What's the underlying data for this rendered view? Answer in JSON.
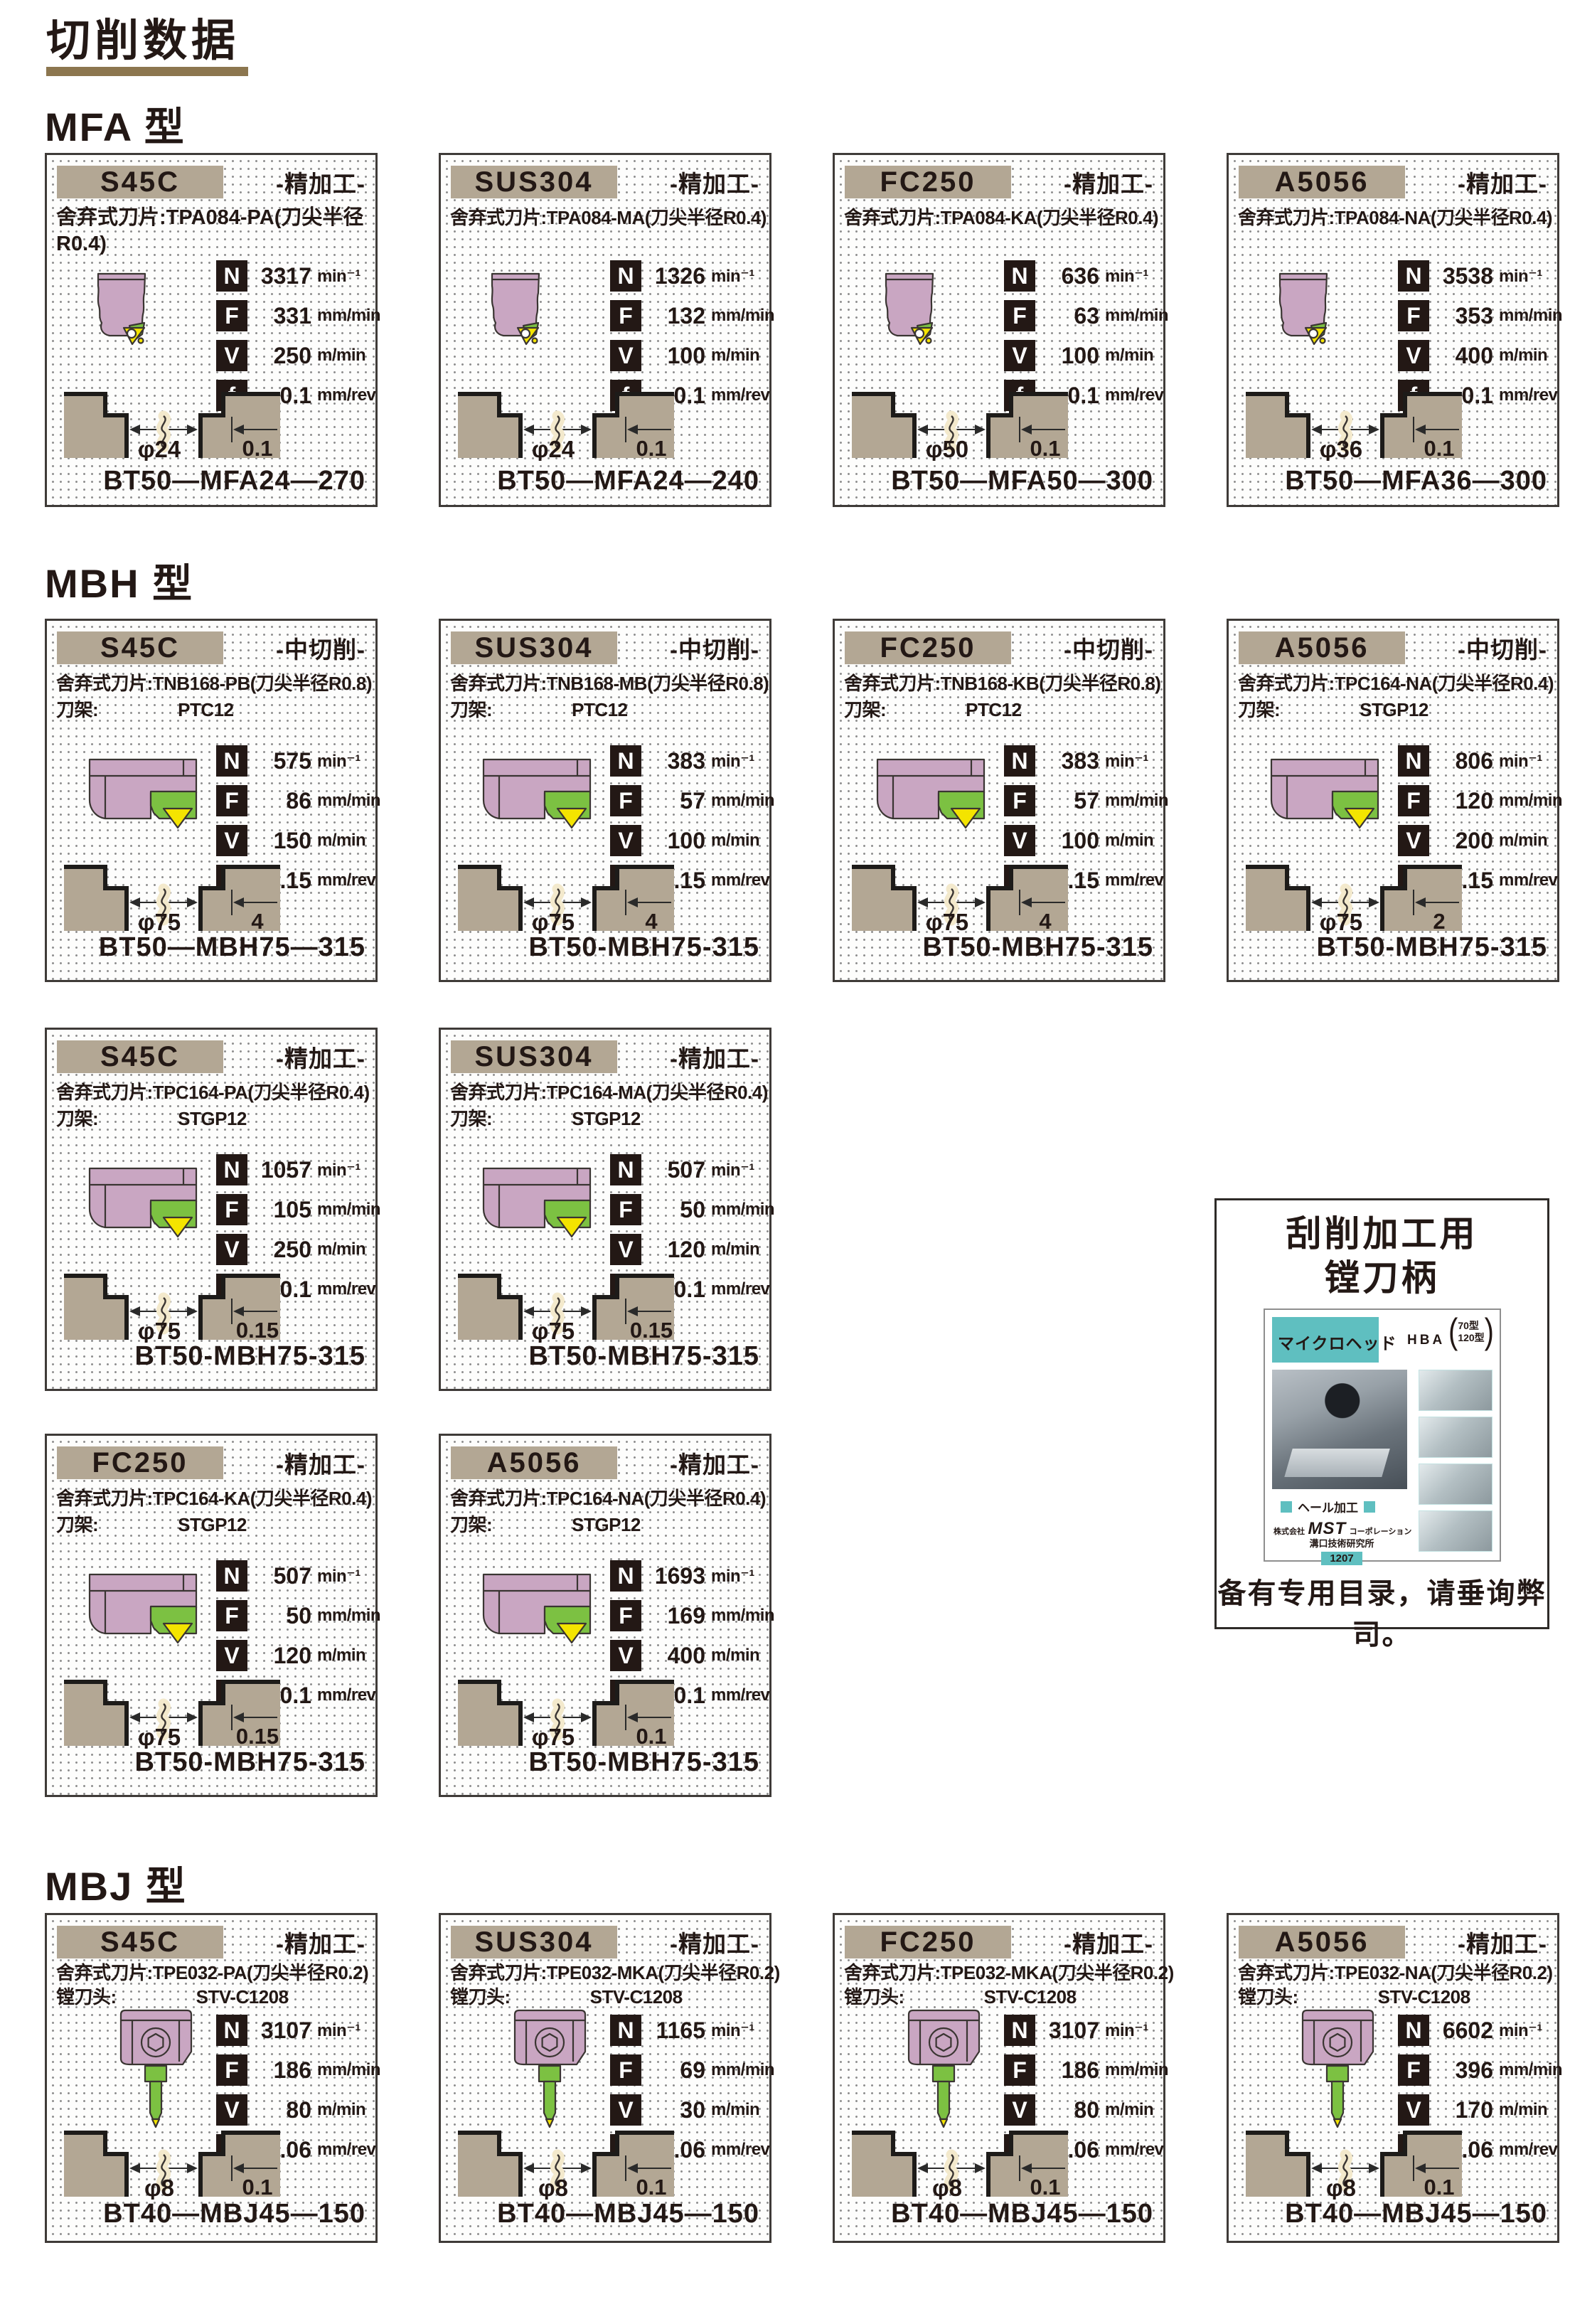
{
  "page": {
    "title": "切削数据"
  },
  "labels": {
    "insert": "舍弃式刀片:",
    "letters": {
      "n": "N",
      "f": "F",
      "v": "V",
      "fr": "f"
    },
    "units": {
      "n": "min⁻¹",
      "f": "mm/min",
      "v": "m/min",
      "fr": "mm/rev"
    }
  },
  "sections": [
    {
      "id": "mfa",
      "title": "MFA 型",
      "rows": [
        [
          {
            "material": "S45C",
            "process": "-精加工-",
            "insert": "TPA084-PA(刀尖半径R0.4)",
            "tool": "mfa",
            "insert_wrap": true,
            "speeds": {
              "n": "3317",
              "f": "331",
              "v": "250",
              "fr": "0.1"
            },
            "dia": "φ24",
            "depth": "0.1",
            "code": "BT50—MFA24—270"
          },
          {
            "material": "SUS304",
            "process": "-精加工-",
            "insert": "TPA084-MA(刀尖半径R0.4)",
            "tool": "mfa",
            "speeds": {
              "n": "1326",
              "f": "132",
              "v": "100",
              "fr": "0.1"
            },
            "dia": "φ24",
            "depth": "0.1",
            "code": "BT50—MFA24—240"
          },
          {
            "material": "FC250",
            "process": "-精加工-",
            "insert": "TPA084-KA(刀尖半径R0.4)",
            "tool": "mfa",
            "speeds": {
              "n": "636",
              "f": "63",
              "v": "100",
              "fr": "0.1"
            },
            "dia": "φ50",
            "depth": "0.1",
            "code": "BT50—MFA50—300"
          },
          {
            "material": "A5056",
            "process": "-精加工-",
            "insert": "TPA084-NA(刀尖半径R0.4)",
            "tool": "mfa",
            "speeds": {
              "n": "3538",
              "f": "353",
              "v": "400",
              "fr": "0.1"
            },
            "dia": "φ36",
            "depth": "0.1",
            "code": "BT50—MFA36—300"
          }
        ]
      ]
    },
    {
      "id": "mbh",
      "title": "MBH 型",
      "rows": [
        [
          {
            "material": "S45C",
            "process": "-中切削-",
            "insert": "TNB168-PB(刀尖半径R0.8)",
            "holder_label": "刀架:",
            "holder": "PTC12",
            "tool": "mbh",
            "speeds": {
              "n": "575",
              "f": "86",
              "v": "150",
              "fr": "0.15"
            },
            "dia": "φ75",
            "depth": "4",
            "code": "BT50—MBH75—315"
          },
          {
            "material": "SUS304",
            "process": "-中切削-",
            "insert": "TNB168-MB(刀尖半径R0.8)",
            "holder_label": "刀架:",
            "holder": "PTC12",
            "tool": "mbh",
            "speeds": {
              "n": "383",
              "f": "57",
              "v": "100",
              "fr": "0.15"
            },
            "dia": "φ75",
            "depth": "4",
            "code": "BT50-MBH75-315"
          },
          {
            "material": "FC250",
            "process": "-中切削-",
            "insert": "TNB168-KB(刀尖半径R0.8)",
            "holder_label": "刀架:",
            "holder": "PTC12",
            "tool": "mbh",
            "speeds": {
              "n": "383",
              "f": "57",
              "v": "100",
              "fr": "0.15"
            },
            "dia": "φ75",
            "depth": "4",
            "code": "BT50-MBH75-315"
          },
          {
            "material": "A5056",
            "process": "-中切削-",
            "insert": "TPC164-NA(刀尖半径R0.4)",
            "holder_label": "刀架:",
            "holder": "STGP12",
            "tool": "mbh",
            "speeds": {
              "n": "806",
              "f": "120",
              "v": "200",
              "fr": "0.15"
            },
            "dia": "φ75",
            "depth": "2",
            "code": "BT50-MBH75-315"
          }
        ],
        [
          {
            "material": "S45C",
            "process": "-精加工-",
            "insert": "TPC164-PA(刀尖半径R0.4)",
            "holder_label": "刀架:",
            "holder": "STGP12",
            "tool": "mbh",
            "speeds": {
              "n": "1057",
              "f": "105",
              "v": "250",
              "fr": "0.1"
            },
            "dia": "φ75",
            "depth": "0.15",
            "code": "BT50-MBH75-315"
          },
          {
            "material": "SUS304",
            "process": "-精加工-",
            "insert": "TPC164-MA(刀尖半径R0.4)",
            "holder_label": "刀架:",
            "holder": "STGP12",
            "tool": "mbh",
            "speeds": {
              "n": "507",
              "f": "50",
              "v": "120",
              "fr": "0.1"
            },
            "dia": "φ75",
            "depth": "0.15",
            "code": "BT50-MBH75-315"
          }
        ],
        [
          {
            "material": "FC250",
            "process": "-精加工-",
            "insert": "TPC164-KA(刀尖半径R0.4)",
            "holder_label": "刀架:",
            "holder": "STGP12",
            "tool": "mbh",
            "speeds": {
              "n": "507",
              "f": "50",
              "v": "120",
              "fr": "0.1"
            },
            "dia": "φ75",
            "depth": "0.15",
            "code": "BT50-MBH75-315"
          },
          {
            "material": "A5056",
            "process": "-精加工-",
            "insert": "TPC164-NA(刀尖半径R0.4)",
            "holder_label": "刀架:",
            "holder": "STGP12",
            "tool": "mbh",
            "speeds": {
              "n": "1693",
              "f": "169",
              "v": "400",
              "fr": "0.1"
            },
            "dia": "φ75",
            "depth": "0.1",
            "code": "BT50-MBH75-315"
          }
        ]
      ]
    },
    {
      "id": "mbj",
      "title": "MBJ 型",
      "rows": [
        [
          {
            "material": "S45C",
            "process": "-精加工-",
            "insert": "TPE032-PA(刀尖半径R0.2)",
            "holder_label": "镗刀头:",
            "holder": "STV-C1208",
            "tool": "mbj",
            "speeds": {
              "n": "3107",
              "f": "186",
              "v": "80",
              "fr": "0.06"
            },
            "dia": "φ8",
            "depth": "0.1",
            "code": "BT40—MBJ45—150"
          },
          {
            "material": "SUS304",
            "process": "-精加工-",
            "insert": "TPE032-MKA(刀尖半径R0.2)",
            "holder_label": "镗刀头:",
            "holder": "STV-C1208",
            "tool": "mbj",
            "speeds": {
              "n": "1165",
              "f": "69",
              "v": "30",
              "fr": "0.06"
            },
            "dia": "φ8",
            "depth": "0.1",
            "code": "BT40—MBJ45—150"
          },
          {
            "material": "FC250",
            "process": "-精加工-",
            "insert": "TPE032-MKA(刀尖半径R0.2)",
            "holder_label": "镗刀头:",
            "holder": "STV-C1208",
            "tool": "mbj",
            "speeds": {
              "n": "3107",
              "f": "186",
              "v": "80",
              "fr": "0.06"
            },
            "dia": "φ8",
            "depth": "0.1",
            "code": "BT40—MBJ45—150"
          },
          {
            "material": "A5056",
            "process": "-精加工-",
            "insert": "TPE032-NA(刀尖半径R0.2)",
            "holder_label": "镗刀头:",
            "holder": "STV-C1208",
            "tool": "mbj",
            "speeds": {
              "n": "6602",
              "f": "396",
              "v": "170",
              "fr": "0.06"
            },
            "dia": "φ8",
            "depth": "0.1",
            "code": "BT40—MBJ45—150"
          }
        ]
      ]
    }
  ],
  "side_box": {
    "title_line1": "刮削加工用",
    "title_line2": "镗刀柄",
    "cover": {
      "product": "マイクロヘッド",
      "model": "HBA",
      "variants": [
        "70型",
        "120型"
      ],
      "tag": "ヘール加工",
      "company_prefix": "株式会社",
      "brand": "MST",
      "company_suffix": "コーポレーション",
      "division": "溝口技術研究所",
      "number": "1207"
    },
    "note": "备有专用目录，请垂询弊司。"
  }
}
